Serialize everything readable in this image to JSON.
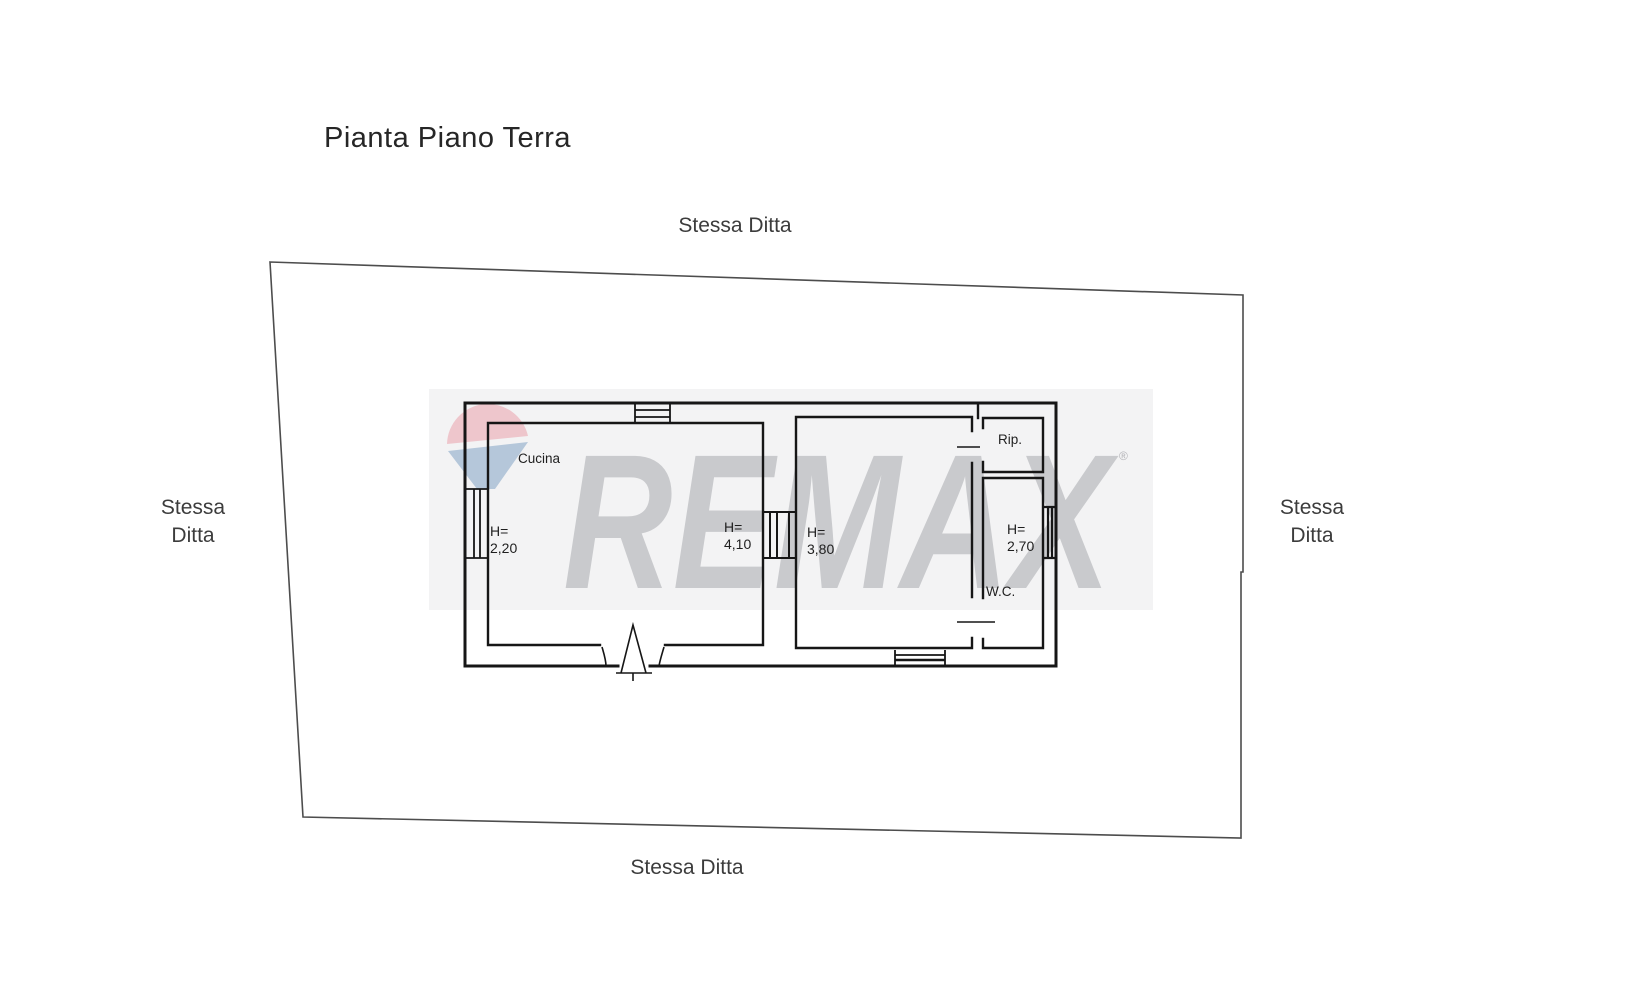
{
  "title": "Pianta Piano Terra",
  "site_labels": {
    "top": "Stessa Ditta",
    "bottom": "Stessa Ditta",
    "left": {
      "line1": "Stessa",
      "line2": "Ditta"
    },
    "right": {
      "line1": "Stessa",
      "line2": "Ditta"
    }
  },
  "plan": {
    "kitchen_label": "Cucina",
    "storage_label": "Rip.",
    "wc_label": "W.C.",
    "heights": {
      "h1": {
        "prefix": "H=",
        "value": "2,20"
      },
      "h2": {
        "prefix": "H=",
        "value": "4,10"
      },
      "h3": {
        "prefix": "H=",
        "value": "3,80"
      },
      "h4": {
        "prefix": "H=",
        "value": "2,70"
      }
    }
  },
  "watermark": {
    "brand": "REMAX",
    "registered": "®",
    "background": "#f3f3f4",
    "letter_color": "#c9cacd",
    "balloon_pink": "#eec6cc",
    "balloon_blue": "#b5c7da"
  }
}
